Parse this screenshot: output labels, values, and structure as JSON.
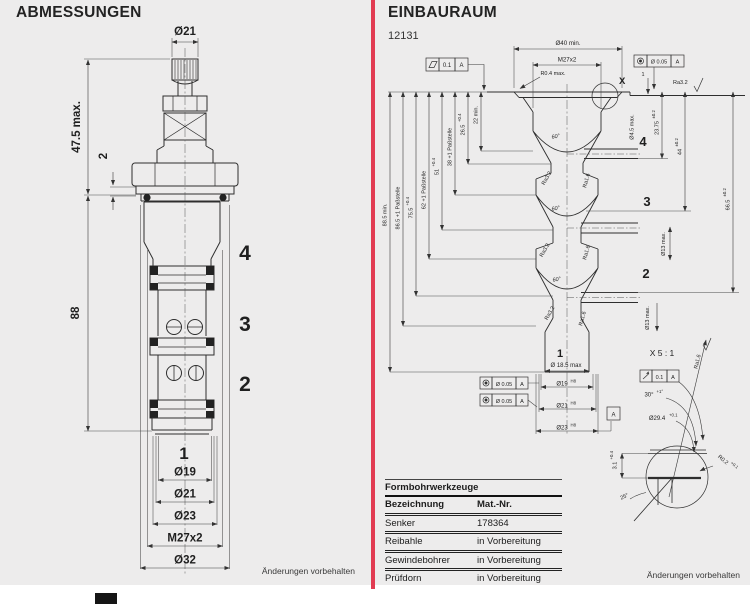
{
  "page": {
    "bg": "#edecec",
    "divider_color": "#e23c52"
  },
  "left": {
    "title": "ABMESSUNGEN",
    "footer": "Änderungen vorbehalten",
    "stage_labels": {
      "s4": "4",
      "s3": "3",
      "s2": "2",
      "s1": "1"
    },
    "dims": {
      "top_dia": "Ø21",
      "height": "47.5 max.",
      "flange": "2",
      "length": "88",
      "d19": "Ø19",
      "d21": "Ø21",
      "d23": "Ø23",
      "thread": "M27x2",
      "d32": "Ø32"
    }
  },
  "right": {
    "title": "EINBAURAUM",
    "number": "12131",
    "footer": "Änderungen vorbehalten",
    "stage_labels": {
      "s4": "4",
      "s3": "3",
      "s2": "2",
      "s1": "1"
    },
    "depths": {
      "d885": "88.5 min.",
      "d865": "86.5 +1 Paßstelle",
      "d755": "75.5",
      "d755_tol": "+0.4",
      "d62": "62 +1 Paßstelle",
      "d51": "51",
      "d51_tol": "+0.4",
      "d38": "38 +1 Paßstelle",
      "d265": "26.5",
      "d265_tol": "+0.4",
      "d22": "22 min."
    },
    "top_dims": {
      "d40": "Ø40 min.",
      "thread": "M27x2",
      "r04": "R0.4 max.",
      "step": "1",
      "ra32": "Ra3.2"
    },
    "right_dims": {
      "d45": "Ø4.5 max.",
      "d2375": "23.75",
      "d2375_tol": "±0.2",
      "d44": "44",
      "d44_tol": "±0.2",
      "d665": "66.5",
      "d665_tol": "±0.2",
      "d13a": "Ø13 max.",
      "d13b": "Ø13 max."
    },
    "cone": {
      "angle60": "60°",
      "ra32": "Ra3.2",
      "ra16": "Ra1.6"
    },
    "bottom_dims": {
      "d185": "Ø 18.5 max",
      "d19": "Ø19",
      "d21": "Ø21",
      "d23": "Ø23",
      "h8": "H8"
    },
    "detail": {
      "marker": "X",
      "title": "X 5 : 1",
      "angle30": "30°",
      "angle30_tol": "+1°",
      "d294": "Ø29.4",
      "d294_tol": "+0.1",
      "r02": "R0.2",
      "r02_tol": "+0.1",
      "depth31": "3.1",
      "depth31_tol": "+0.4",
      "angle25": "25°",
      "ra16": "Ra1.6"
    },
    "frames": {
      "flat_tol": "0.1",
      "flat_datum": "A",
      "conc_tol": "Ø 0.05",
      "conc_datum": "A",
      "runout_tol": "0.1",
      "runout_datum": "A",
      "datum": "A"
    },
    "table": {
      "title": "Formbohrwerkzeuge",
      "col1": "Bezeichnung",
      "col2": "Mat.-Nr.",
      "rows": [
        {
          "name": "Senker",
          "mat": "178364"
        },
        {
          "name": "Reibahle",
          "mat": "in Vorbereitung"
        },
        {
          "name": "Gewindebohrer",
          "mat": "in Vorbereitung"
        },
        {
          "name": "Prüfdorn",
          "mat": "in Vorbereitung"
        }
      ]
    }
  }
}
